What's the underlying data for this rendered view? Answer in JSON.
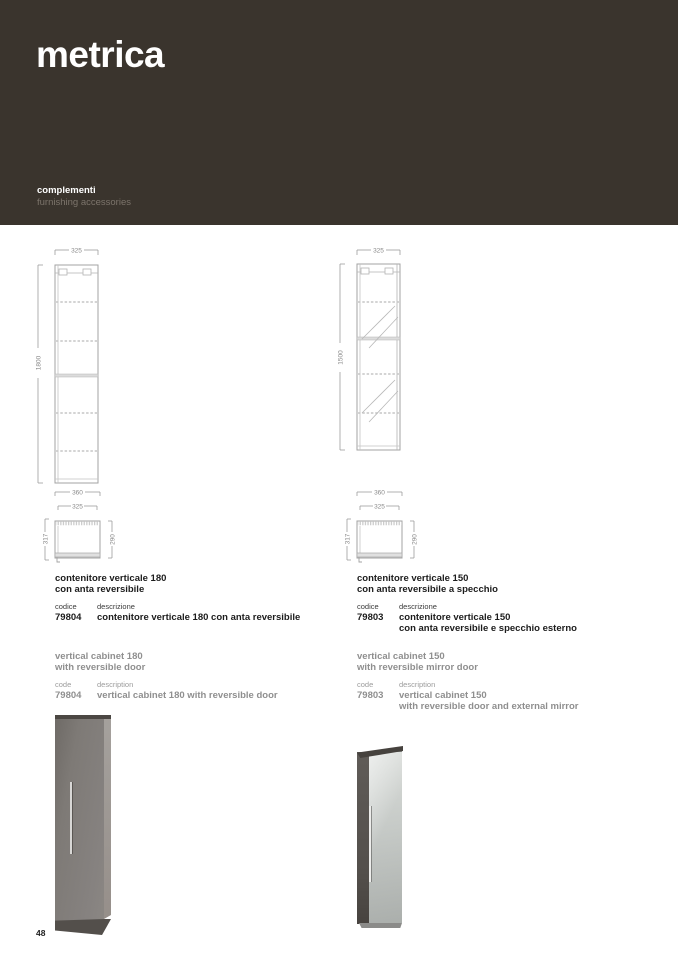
{
  "header": {
    "brand": "metrica",
    "category_it": "complementi",
    "category_en": "furnishing accessories",
    "bg_color": "#3a342d"
  },
  "footer": {
    "page_number": "48"
  },
  "colors": {
    "header_bg": "#3a342d",
    "english_text": "#8f8f8f",
    "drawing_line": "#a3a3a3",
    "cabinet_grey": "#7e7a76",
    "mirror_light": "#d9dcd9"
  },
  "products": [
    {
      "drawing": {
        "front_width": "325",
        "height": "1800",
        "plan_width_outer": "360",
        "plan_width_inner": "325",
        "plan_depth_total": "317",
        "plan_depth_body": "290"
      },
      "it": {
        "title1": "contenitore verticale 180",
        "title2": "con anta reversibile",
        "code_label": "codice",
        "desc_label": "descrizione",
        "code": "79804",
        "desc1": "contenitore verticale 180 con anta reversibile"
      },
      "en": {
        "title1": "vertical cabinet 180",
        "title2": "with reversible door",
        "code_label": "code",
        "desc_label": "description",
        "code": "79804",
        "desc1": "vertical cabinet 180 with reversible door"
      }
    },
    {
      "drawing": {
        "front_width": "325",
        "height": "1500",
        "plan_width_outer": "360",
        "plan_width_inner": "325",
        "plan_depth_total": "317",
        "plan_depth_body": "290"
      },
      "it": {
        "title1": "contenitore verticale 150",
        "title2": "con anta reversibile a specchio",
        "code_label": "codice",
        "desc_label": "descrizione",
        "code": "79803",
        "desc1": "contenitore verticale 150",
        "desc2": "con anta reversibile e specchio esterno"
      },
      "en": {
        "title1": "vertical cabinet 150",
        "title2": "with reversible mirror door",
        "code_label": "code",
        "desc_label": "description",
        "code": "79803",
        "desc1": "vertical cabinet 150",
        "desc2": "with reversible door and external mirror"
      }
    }
  ]
}
